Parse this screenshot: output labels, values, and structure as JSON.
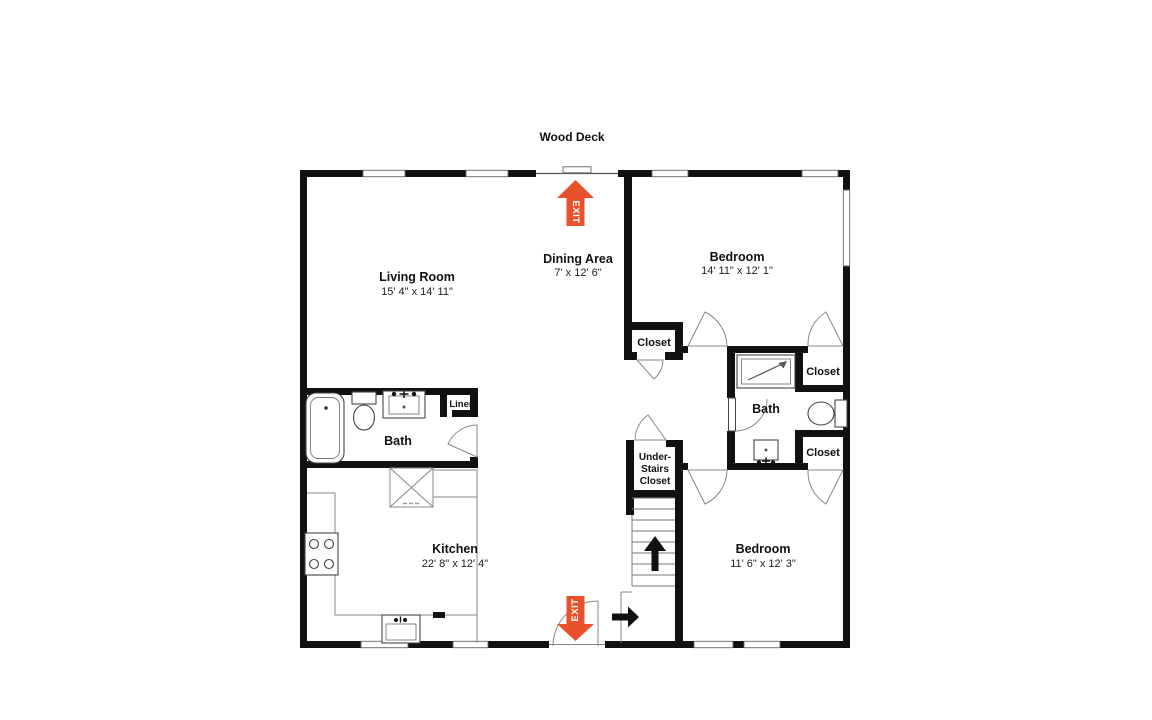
{
  "plan": {
    "deck_label": "Wood Deck",
    "exit_label": "EXIT",
    "rooms": {
      "living": {
        "name": "Living Room",
        "dims": "15' 4\" x 14' 11\""
      },
      "dining": {
        "name": "Dining Area",
        "dims": "7' x 12' 6\""
      },
      "bedroom_top": {
        "name": "Bedroom",
        "dims": "14' 11\" x 12' 1\""
      },
      "bedroom_bottom": {
        "name": "Bedroom",
        "dims": "11' 6\" x 12' 3\""
      },
      "kitchen": {
        "name": "Kitchen",
        "dims": "22' 8\" x 12' 4\""
      },
      "bath_left": {
        "name": "Bath"
      },
      "bath_middle": {
        "name": "Bath"
      }
    },
    "closets": {
      "hall": "Closet",
      "bedroom_top": "Closet",
      "bedroom_bottom": "Closet",
      "linen": "Linen",
      "under_stairs": [
        "Under-",
        "Stairs",
        "Closet"
      ]
    },
    "colors": {
      "exit_arrow": "#E8512C",
      "wall": "#111111"
    }
  }
}
